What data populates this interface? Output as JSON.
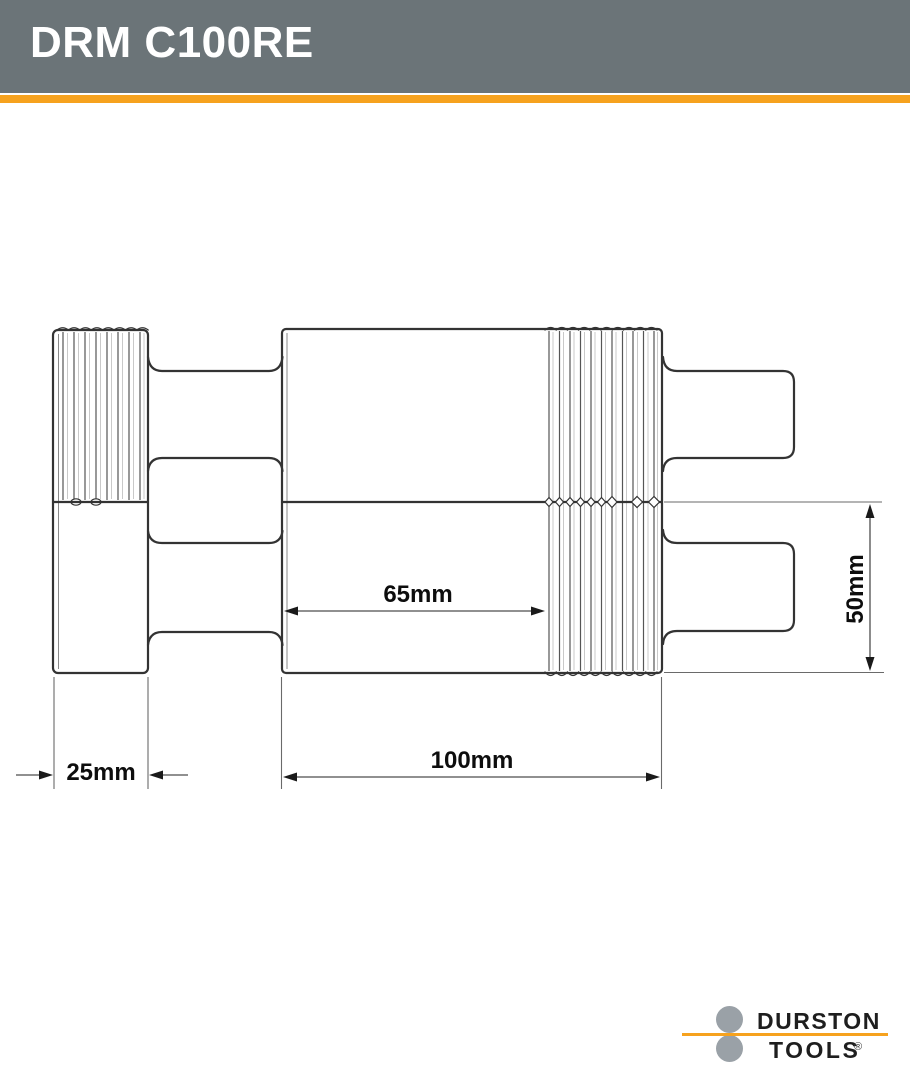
{
  "header": {
    "title": "DRM C100RE",
    "bg_color": "#6B7478",
    "accent_color": "#F6A21E"
  },
  "drawing": {
    "labels": {
      "flat_section_width": "65mm",
      "roller_diameter": "50mm",
      "extension_width": "25mm",
      "roller_width": "100mm"
    }
  },
  "logo": {
    "line1": "DURSTON",
    "line2": "TOOLS",
    "registered": "®",
    "circle_color": "#9aa1a7",
    "line_color": "#F6A21E"
  }
}
